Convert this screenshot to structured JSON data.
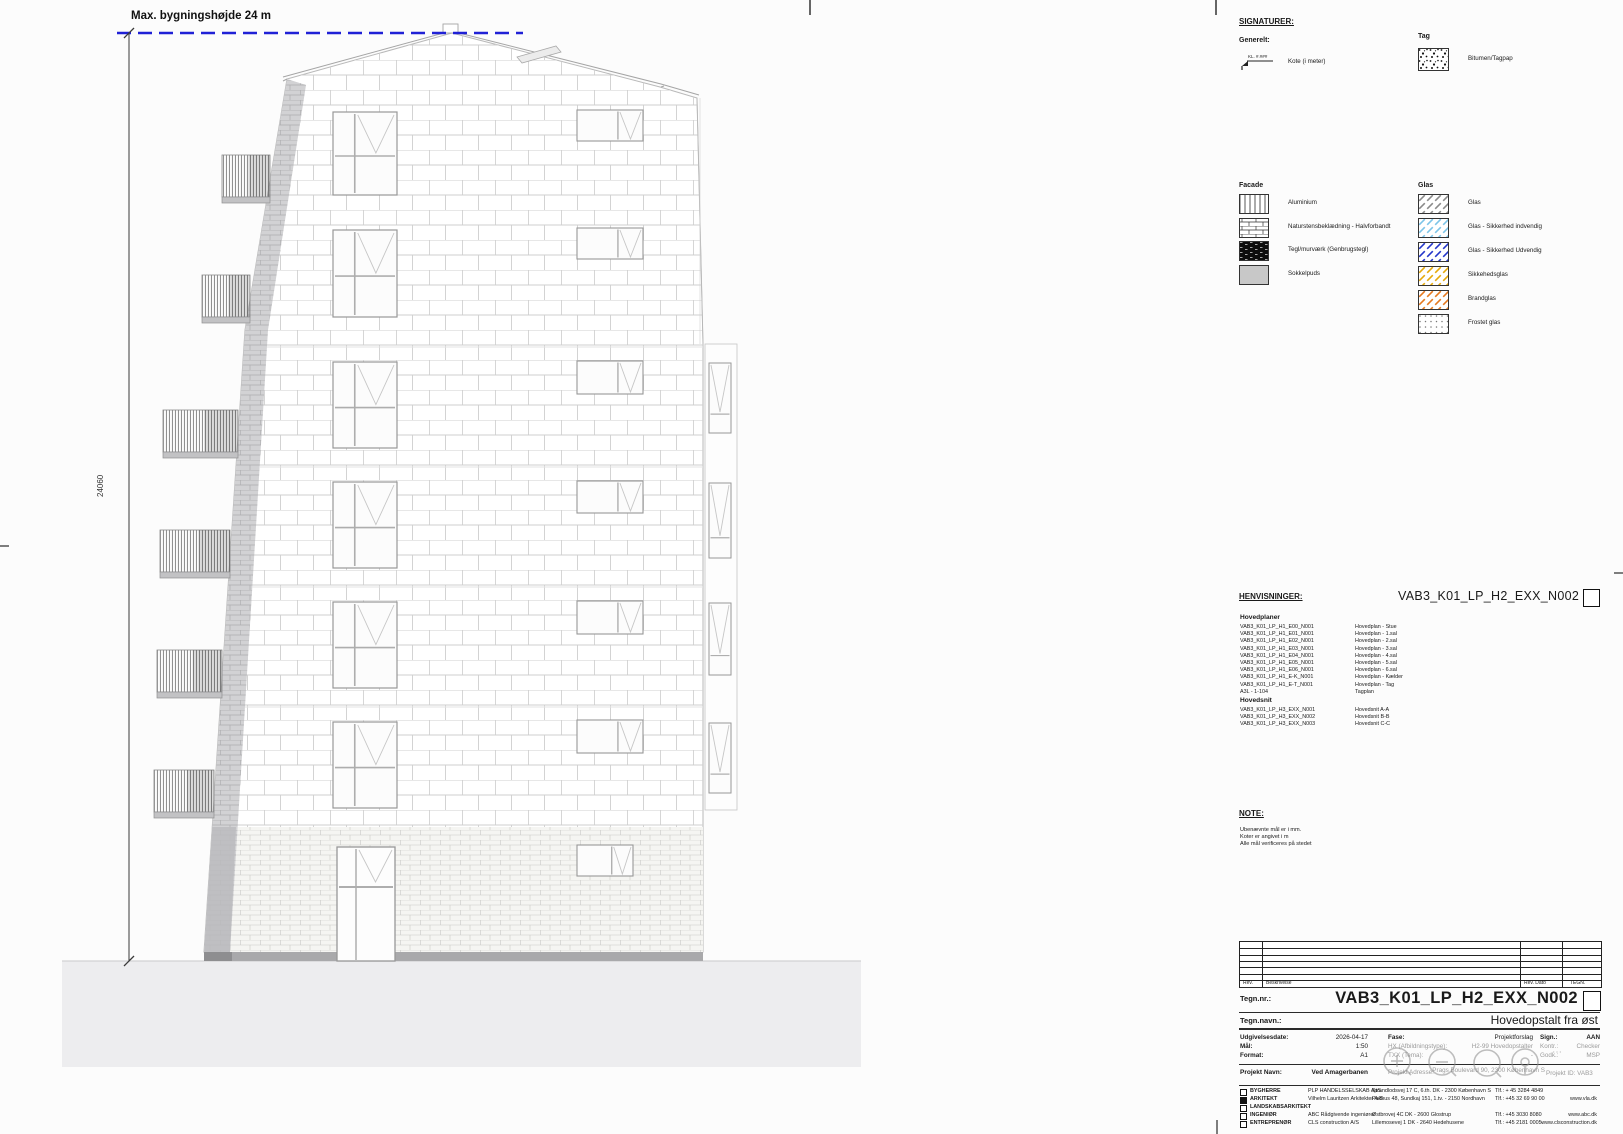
{
  "sheet": {
    "max_height_label": "Max. bygningshøjde 24 m",
    "height_dimension_mm": "24060"
  },
  "signaturer": {
    "title": "SIGNATURER:",
    "generelt_title": "Generelt:",
    "kote": {
      "symbol_text": "KL. #.###",
      "label": "Kote (i meter)"
    },
    "tag_title": "Tag",
    "tag_items": [
      {
        "pattern": "bitumen",
        "label": "Bitumen/Tagpap"
      }
    ],
    "facade_title": "Facade",
    "facade_items": [
      {
        "pattern": "vlines",
        "label": "Aluminium"
      },
      {
        "pattern": "brick",
        "label": "Naturstensbeklædning - Halvforbandt"
      },
      {
        "pattern": "darkbrick",
        "label": "Tegl/murværk (Genbrugstegl)"
      },
      {
        "pattern": "solidgray",
        "label": "Sokkelpuds"
      }
    ],
    "glas_title": "Glas",
    "glas_items": [
      {
        "pattern": "dashgray",
        "label": "Glas"
      },
      {
        "pattern": "dashlblue",
        "label": "Glas - Sikkerhed indvendig"
      },
      {
        "pattern": "dashblue",
        "label": "Glas - Sikkerhed Udvendig"
      },
      {
        "pattern": "dashyellow",
        "label": "Sikkehedsglas"
      },
      {
        "pattern": "dashorange",
        "label": "Brandglas"
      },
      {
        "pattern": "dots",
        "label": "Frostet glas"
      }
    ]
  },
  "henvisninger": {
    "title": "HENVISNINGER:",
    "doc_code": "VAB3_K01_LP_H2_EXX_N002",
    "hovedplaner_title": "Hovedplaner",
    "hovedplaner": [
      {
        "code": "VAB3_K01_LP_H1_E00_N001",
        "label": "Hovedplan - Stue"
      },
      {
        "code": "VAB3_K01_LP_H1_E01_N001",
        "label": "Hovedplan - 1.sal"
      },
      {
        "code": "VAB3_K01_LP_H1_E02_N001",
        "label": "Hovedplan - 2.sal"
      },
      {
        "code": "VAB3_K01_LP_H1_E03_N001",
        "label": "Hovedplan - 3.sal"
      },
      {
        "code": "VAB3_K01_LP_H1_E04_N001",
        "label": "Hovedplan - 4.sal"
      },
      {
        "code": "VAB3_K01_LP_H1_E05_N001",
        "label": "Hovedplan - 5.sal"
      },
      {
        "code": "VAB3_K01_LP_H1_E06_N001",
        "label": "Hovedplan - 6.sal"
      },
      {
        "code": "VAB3_K01_LP_H1_E-K_N001",
        "label": "Hovedplan - Kælder"
      },
      {
        "code": "VAB3_K01_LP_H1_E-T_N001",
        "label": "Hovedplan - Tag"
      },
      {
        "code": "A3L - 1-104",
        "label": "Tagplan"
      }
    ],
    "hovedsnit_title": "Hovedsnit",
    "hovedsnit": [
      {
        "code": "VAB3_K01_LP_H3_EXX_N001",
        "label": "Hovedsnit A-A"
      },
      {
        "code": "VAB3_K01_LP_H3_EXX_N002",
        "label": "Hovedsnit B-B"
      },
      {
        "code": "VAB3_K01_LP_H3_EXX_N003",
        "label": "Hovedsnit C-C"
      }
    ]
  },
  "note": {
    "title": "NOTE:",
    "lines": [
      "Ubenævnte mål er i mm.",
      "Koter er angivet i m",
      "Alle mål verificeres på stedet"
    ]
  },
  "titleblock": {
    "revision": {
      "headers": [
        "Rev.",
        "Beskrivelse",
        "Rev. Dato",
        "TEGN."
      ],
      "empty_rows": 6
    },
    "tegn_nr_label": "Tegn.nr.:",
    "tegn_nr_value": "VAB3_K01_LP_H2_EXX_N002",
    "tegn_navn_label": "Tegn.navn.:",
    "tegn_navn_value": "Hovedopstalt fra øst",
    "fields": {
      "udgivelsesdate": {
        "label": "Udgivelsesdate:",
        "value": "2026-04-17"
      },
      "maal": {
        "label": "Mål:",
        "value": "1:50"
      },
      "format": {
        "label": "Format:",
        "value": "A1"
      },
      "fase": {
        "label": "Fase:",
        "value": "Projektforslag"
      },
      "hx": {
        "label": "HX (Afbildningstype):",
        "value": "H2-99 Hovedopstalter"
      },
      "txx": {
        "label": "TXX (Tema):",
        "value": "-"
      },
      "sign": {
        "label": "Sign.:",
        "value": "AAN"
      },
      "kontr": {
        "label": "Kontr.:",
        "value": "Checker"
      },
      "godk": {
        "label": "Godk.:",
        "value": "MSP"
      },
      "projekt_navn": {
        "label": "Projekt Navn:",
        "value": "Ved Amagerbanen"
      },
      "projekt_adresse": {
        "label": "Projekt Adresse:",
        "value": "Prags Boulevard 90, 2300 København S"
      },
      "projekt_id": {
        "label": "Projekt ID:",
        "value": "VAB3"
      }
    },
    "parties": [
      {
        "role": "BYGHERRE",
        "filled": false,
        "company": "PLP HANDELSSELSKAB ApS",
        "address": "Strandlodsvej 17 C, 6.th. DK - 2300 København S",
        "phone": "Tlf.: + 45 3284 4849",
        "web": ""
      },
      {
        "role": "ARKITEKT",
        "filled": true,
        "company": "Vilhelm Lauritzen Arkitekter A/S",
        "address": "Pakhus 48, Sundkaj 151, 1.tv. - 2150 Nordhavn",
        "phone": "Tlf.: +45 32 69 90 00",
        "web": "www.vla.dk"
      },
      {
        "role": "LANDSKABSARKITEKT",
        "filled": false,
        "company": "-",
        "address": "",
        "phone": "",
        "web": ""
      },
      {
        "role": "INGENIØR",
        "filled": false,
        "company": "ABC Rådgivende ingeniører",
        "address": "Østbrovej 4C DK - 2600 Glostrup",
        "phone": "Tlf.: +45 3030 8080",
        "web": "www.abc.dk"
      },
      {
        "role": "ENTREPRENØR",
        "filled": false,
        "company": "CLS construction A/S",
        "address": "Lillemosevej 1 DK - 2640 Hedehusene",
        "phone": "Tlf.: +45 2181 0005",
        "web": "www.clsconstruction.dk"
      }
    ]
  },
  "viewer": {
    "ellipsis": "⋯"
  },
  "colors": {
    "max_height_line": "#2021d6",
    "glas_sikkerhed_indvendig": "#7cc4e8",
    "glas_sikkerhed_udvendig": "#2336c9",
    "sikkehedsglas": "#e5a90a",
    "brandglas": "#e5791e",
    "sokkelpuds": "#c8c8c8"
  }
}
